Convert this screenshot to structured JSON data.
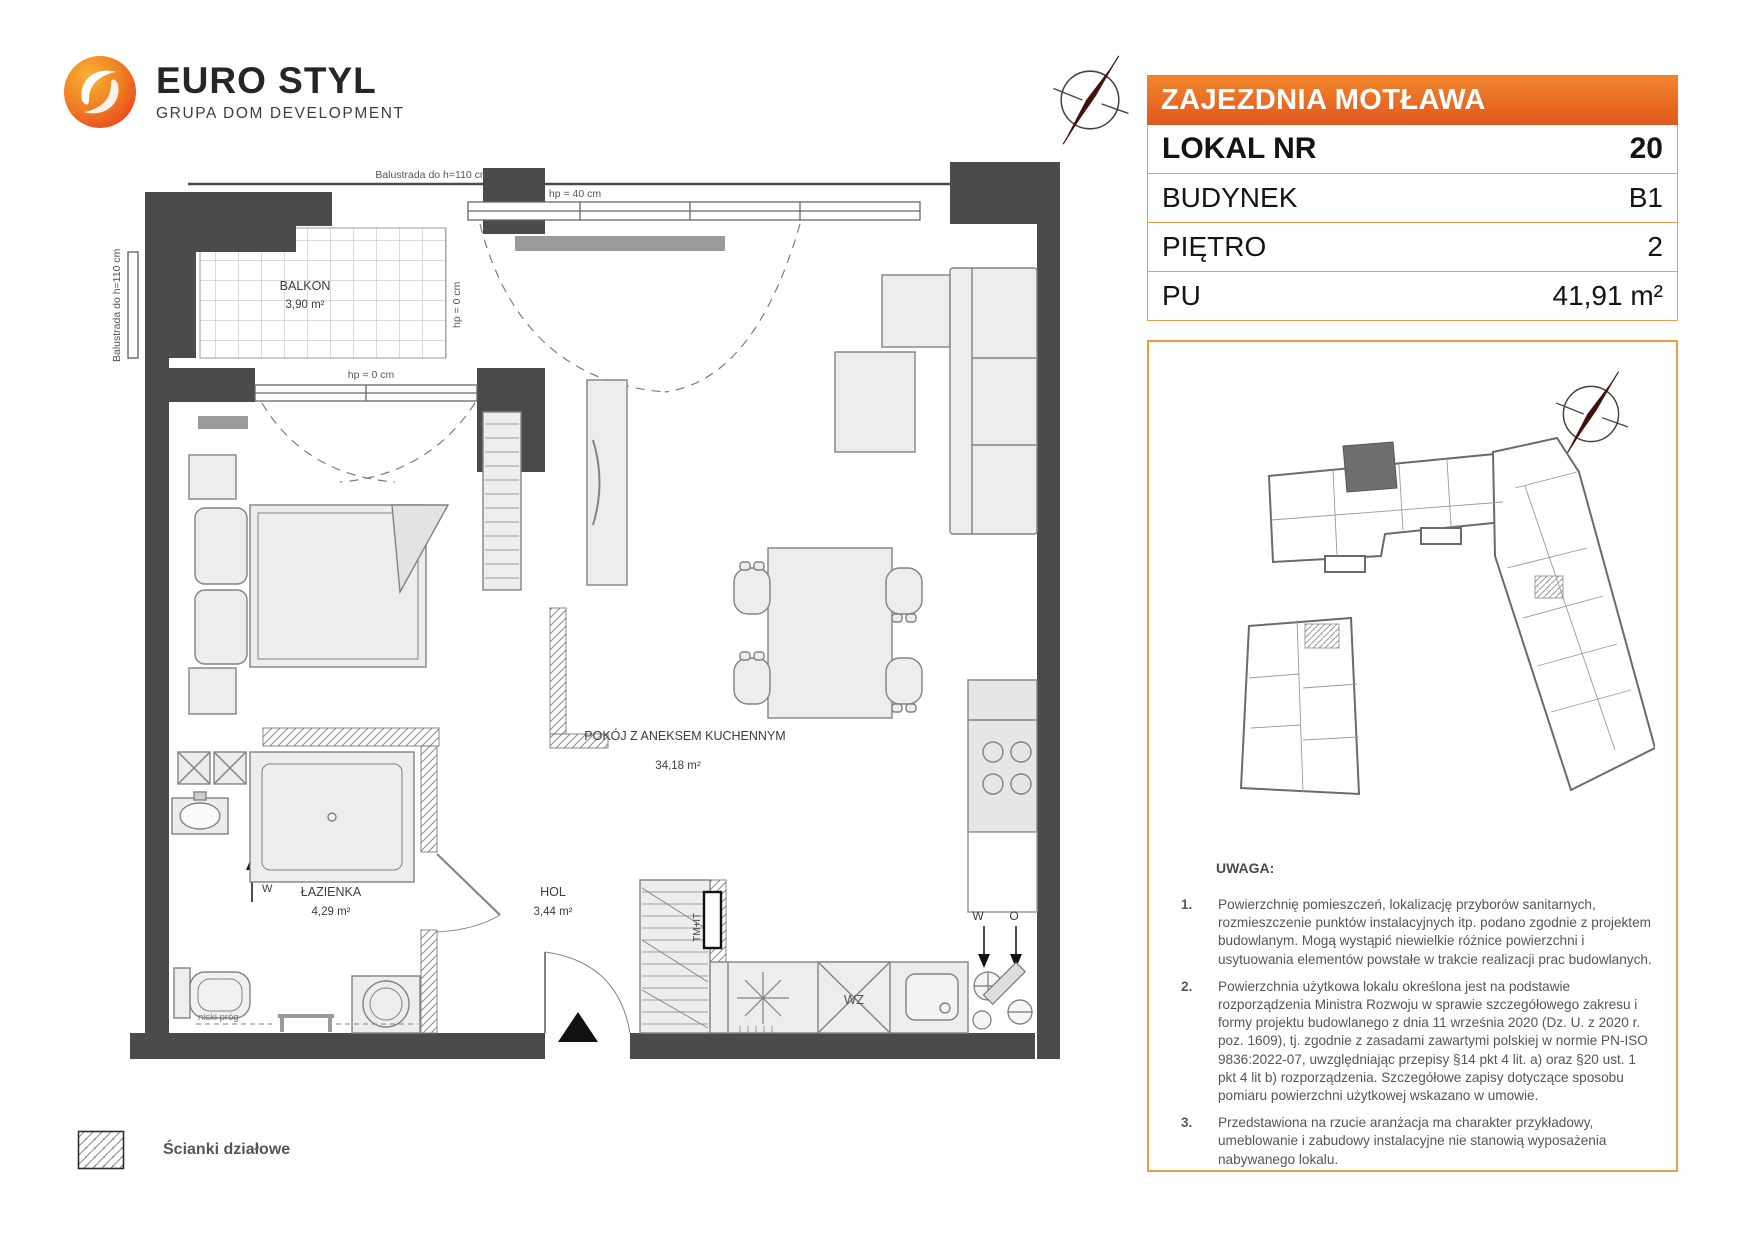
{
  "logo": {
    "brand": "EURO STYL",
    "subtitle": "GRUPA DOM DEVELOPMENT"
  },
  "header": {
    "project": "ZAJEZDNIA MOTŁAWA"
  },
  "details": {
    "rows": [
      {
        "label": "LOKAL NR",
        "value": "20"
      },
      {
        "label": "BUDYNEK",
        "value": "B1"
      },
      {
        "label": "PIĘTRO",
        "value": "2"
      },
      {
        "label": "PU",
        "value": "41,91 m²"
      }
    ]
  },
  "plan": {
    "rooms": [
      {
        "name": "BALKON",
        "area": "3,90 m²"
      },
      {
        "name": "POKÓJ Z ANEKSEM KUCHENNYM",
        "area": "34,18 m²"
      },
      {
        "name": "ŁAZIENKA",
        "area": "4,29 m²"
      },
      {
        "name": "HOL",
        "area": "3,44 m²"
      }
    ],
    "annotations": {
      "balustrade_top": "Balustrada do h=110 cm",
      "balustrade_left": "Balustrada do h=110 cm",
      "hp40": "hp = 40 cm",
      "hp0_vertical": "hp = 0 cm",
      "hp0_horizontal": "hp = 0 cm",
      "niski_prog": "niski próg",
      "tm_it": "TM+IT",
      "wz": "WZ",
      "w_kitchen": "W",
      "o_kitchen": "O",
      "w_bath": "W"
    }
  },
  "legend": {
    "partition_walls": "Ścianki działowe"
  },
  "notes": {
    "title": "UWAGA:",
    "items": [
      {
        "num": "1.",
        "text": "Powierzchnię pomieszczeń, lokalizację przyborów sanitarnych, rozmieszczenie punktów instalacyjnych itp. podano zgodnie z projektem budowlanym. Mogą wystąpić niewielkie różnice powierzchni i usytuowania elementów powstałe w trakcie realizacji prac budowlanych."
      },
      {
        "num": "2.",
        "text": "Powierzchnia użytkowa lokalu określona jest na podstawie rozporządzenia Ministra Rozwoju w sprawie szczegółowego zakresu i formy projektu budowlanego z dnia 11 września 2020 (Dz. U. z 2020 r. poz. 1609), tj. zgodnie z zasadami zawartymi polskiej w normie PN-ISO 9836:2022-07, uwzględniając przepisy §14 pkt 4 lit. a) oraz §20 ust. 1 pkt 4 lit b) rozporządzenia. Szczegółowe zapisy dotyczące sposobu pomiaru powierzchni użytkowej wskazano w umowie."
      },
      {
        "num": "3.",
        "text": "Przedstawiona na rzucie aranżacja ma charakter przykładowy, umeblowanie i zabudowy instalacyjne nie stanowią wyposażenia nabywanego lokalu."
      }
    ]
  },
  "colors": {
    "accent_orange": "#e87722",
    "border_orange": "#ef9b43",
    "wall_dark": "#4b4b4b",
    "furniture_fill": "#ededed",
    "radiator_gray": "#9a9a9a"
  }
}
